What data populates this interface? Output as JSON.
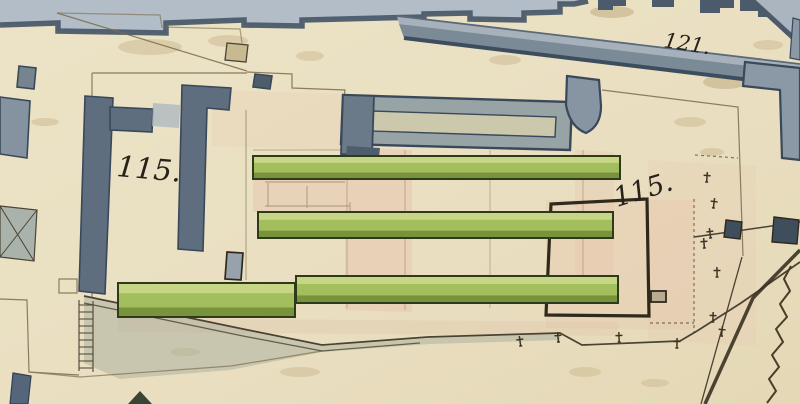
{
  "map": {
    "parcel_labels": [
      {
        "id": "parcel-115-left",
        "text": "115.",
        "x": 116,
        "y": 176,
        "rotation": 5,
        "size": 29
      },
      {
        "id": "parcel-115-right",
        "text": "115.",
        "x": 617,
        "y": 207,
        "rotation": -17,
        "size": 27
      },
      {
        "id": "parcel-121",
        "text": "121.",
        "x": 663,
        "y": 47,
        "rotation": 9,
        "size": 21
      }
    ],
    "colors": {
      "paper": "#ebe1c3",
      "paper_dark": "#e3d7b4",
      "blotch": "#d3c29b",
      "street_light": "#b2bdc8",
      "street_edge": "#4c5b6b",
      "street2_light": "#a7b1bc",
      "street2_dark": "#7b8a97",
      "gray_fill": "#96a1a9",
      "gray_dark": "#5c6b7b",
      "gray_stroke": "#39485a",
      "courtyard": "#cbc8ac",
      "green_light": "#c6d684",
      "green_mid": "#a3be5c",
      "green_dark": "#79923c",
      "green_ink": "#2e3a19",
      "ink": "#3a3325",
      "enclosure_ink": "#2f2a1d",
      "pencil": "#7a6b4c",
      "pink_wash": "#e7c3ad",
      "gray_green_wash": "#a8ad9b"
    },
    "green_buildings": [
      {
        "x": 253,
        "y": 156,
        "w": 367,
        "h": 23
      },
      {
        "x": 258,
        "y": 212,
        "w": 355,
        "h": 26
      },
      {
        "x": 296,
        "y": 276,
        "w": 322,
        "h": 27
      },
      {
        "x": 118,
        "y": 283,
        "w": 177,
        "h": 34
      }
    ],
    "boundary_crosses": [
      [
        520,
        341
      ],
      [
        558,
        337
      ],
      [
        619,
        337
      ],
      [
        677,
        343
      ],
      [
        707,
        177
      ],
      [
        714,
        203
      ],
      [
        710,
        233
      ],
      [
        704,
        243
      ],
      [
        717,
        272
      ],
      [
        713,
        317
      ],
      [
        722,
        331
      ]
    ]
  }
}
